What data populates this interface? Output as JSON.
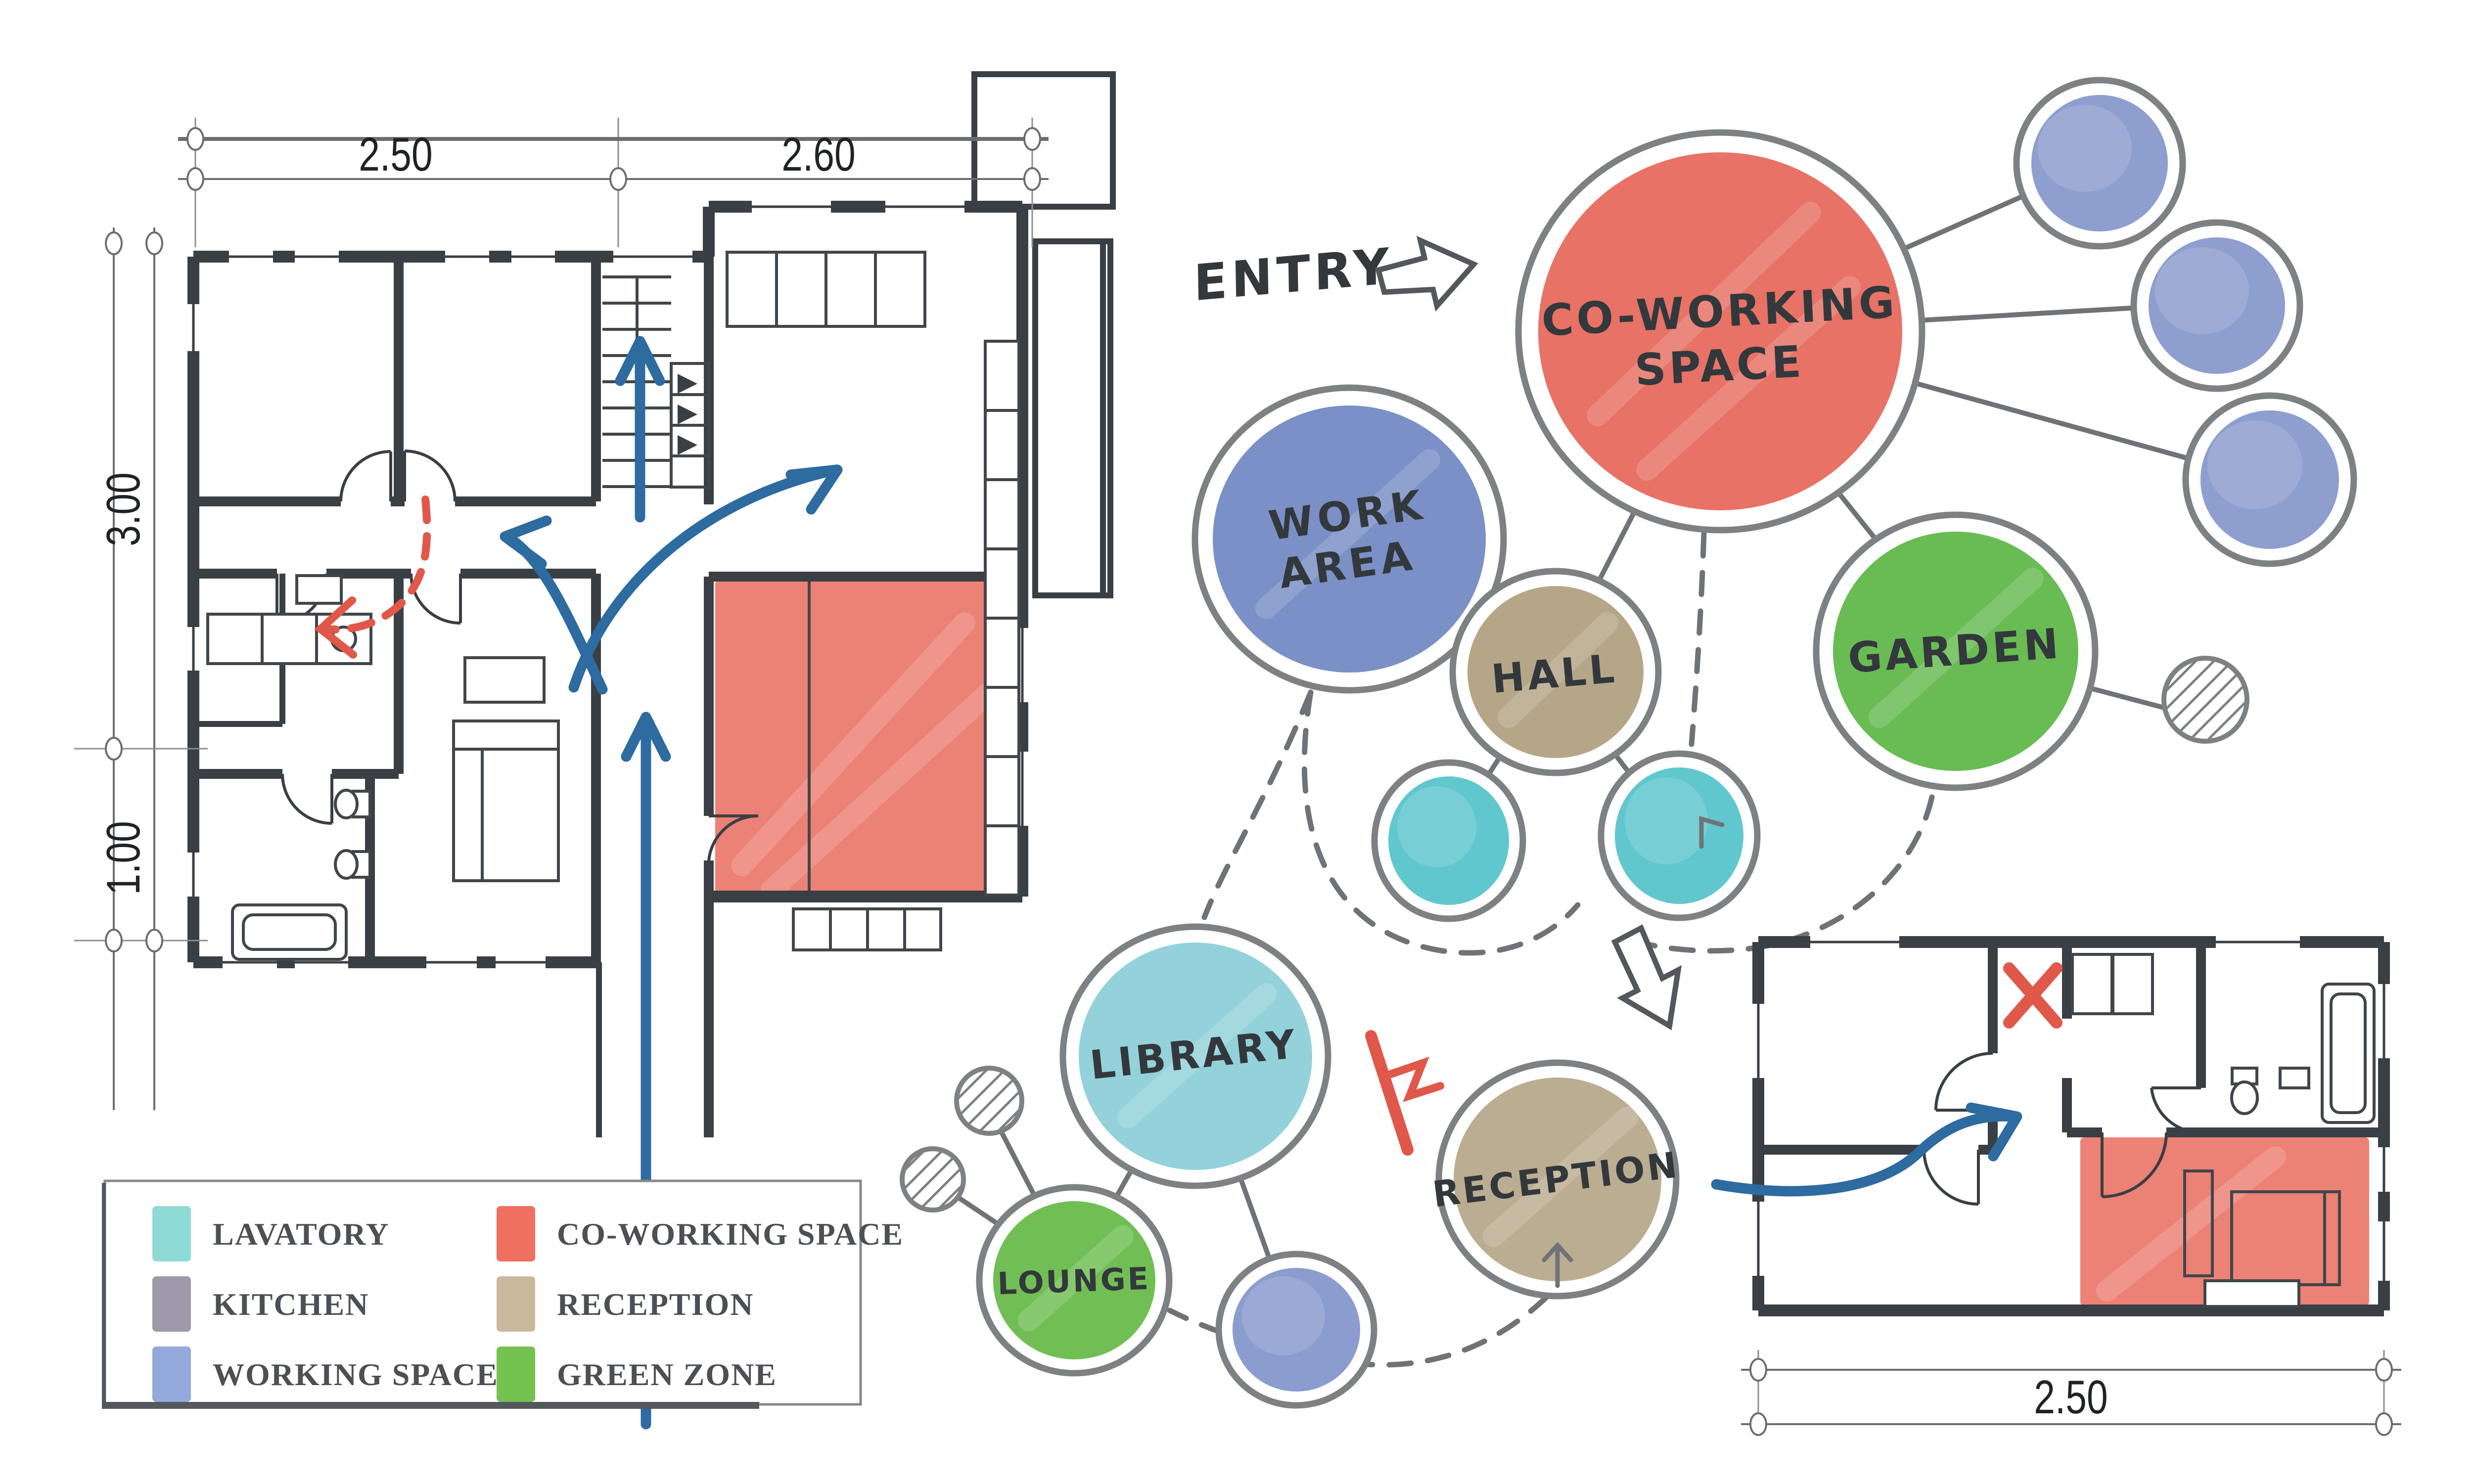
{
  "entry": {
    "label": "ENTRY"
  },
  "bubbles": {
    "coworking": {
      "line1": "CO-WORKING",
      "line2": "SPACE",
      "color": "#e6695b"
    },
    "work_area": {
      "line1": "WORK",
      "line2": "AREA",
      "color": "#7289c2"
    },
    "hall": {
      "label": "HALL",
      "color": "#b1a081"
    },
    "garden": {
      "label": "GARDEN",
      "color": "#5fb848"
    },
    "library": {
      "label": "LIBRARY",
      "color": "#8ccfd8"
    },
    "lounge": {
      "label": "LOUNGE",
      "color": "#68bb49"
    },
    "reception": {
      "label": "RECEPTION",
      "color": "#b7a88a"
    },
    "lavatory_color": "#57c4cc",
    "satellite_color": "#8496cb"
  },
  "legend": {
    "items": [
      {
        "label": "LAVATORY",
        "color": "#8edbd6"
      },
      {
        "label": "KITCHEN",
        "color": "#9e99ab"
      },
      {
        "label": "WORKING SPACE",
        "color": "#93a9dc"
      },
      {
        "label": "CO-WORKING SPACE",
        "color": "#ef6f60"
      },
      {
        "label": "RECEPTION",
        "color": "#c9b99c"
      },
      {
        "label": "GREEN ZONE",
        "color": "#74c24f"
      }
    ]
  },
  "plan_a": {
    "dim_top_left": "2.50",
    "dim_top_right": "2.60",
    "dim_left_upper": "3.00",
    "dim_left_lower": "1.00"
  },
  "plan_b": {
    "dim_bottom": "2.50"
  },
  "colors": {
    "wall": "#3a3f45",
    "ink": "#33383c",
    "connector": "#6f7377",
    "blue_arrow": "#2d6ba0",
    "red_marker": "#e0584a",
    "highlight_red": "#e8695a"
  }
}
